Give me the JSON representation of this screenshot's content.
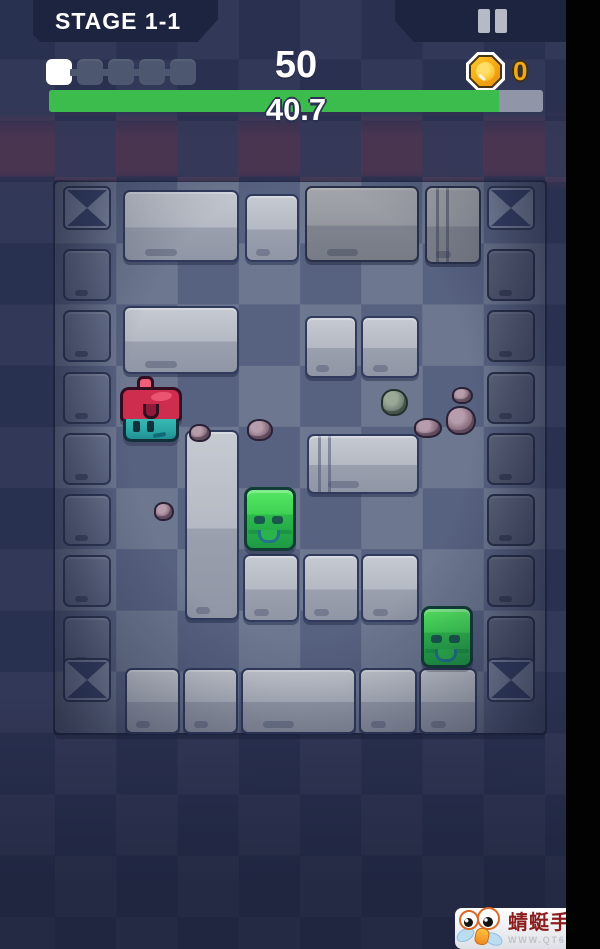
{
  "hud": {
    "stage_label": "STAGE 1-1",
    "score": "50",
    "coin_count": "0",
    "lives": {
      "total": 5,
      "filled": 1
    },
    "progress": {
      "label": "40.7",
      "percent": 91
    }
  },
  "icons": {
    "pause": "pause-icon",
    "coin": "coin-icon",
    "life_square": "life-pip-icon"
  },
  "colors": {
    "background_navy": "#2b3252",
    "panel_navy": "#1d2440",
    "progress_green": "#3bbc4d",
    "progress_track_gray": "#9096a7",
    "coin_gold": "#efa91b",
    "life_filled_white": "#ffffff",
    "life_empty_gray": "#4e5770",
    "slime_green": "#3ed254",
    "player_cap_red": "#ce2d4d",
    "player_body_teal": "#2aa5a3",
    "letterbox_black": "#020203"
  },
  "watermark": {
    "site_name": "蜻蜓手游网",
    "site_url": "WWW.QT6.COM"
  },
  "scene": {
    "field": {
      "x": 55,
      "y": 182,
      "w": 490,
      "h": 551,
      "cols": 8,
      "rows": 9
    },
    "corners": [
      [
        8,
        4
      ],
      [
        432,
        4
      ],
      [
        8,
        476
      ],
      [
        432,
        476
      ]
    ],
    "border_columns": {
      "ys": [
        67,
        128,
        190,
        251,
        312,
        373,
        434
      ],
      "left_x": 8,
      "right_x": 432
    },
    "slabs": [
      {
        "x": 68,
        "y": 8,
        "w": 116,
        "h": 72,
        "v": "light"
      },
      {
        "x": 190,
        "y": 12,
        "w": 54,
        "h": 68,
        "v": "light"
      },
      {
        "x": 250,
        "y": 4,
        "w": 114,
        "h": 76,
        "v": "dim"
      },
      {
        "x": 370,
        "y": 4,
        "w": 56,
        "h": 78,
        "v": "dim",
        "seams": true
      },
      {
        "x": 68,
        "y": 124,
        "w": 116,
        "h": 68,
        "v": "light"
      },
      {
        "x": 250,
        "y": 134,
        "w": 52,
        "h": 62,
        "v": "light"
      },
      {
        "x": 306,
        "y": 134,
        "w": 58,
        "h": 62,
        "v": "light"
      },
      {
        "x": 130,
        "y": 248,
        "w": 54,
        "h": 190,
        "v": "light"
      },
      {
        "x": 252,
        "y": 252,
        "w": 112,
        "h": 60,
        "v": "light",
        "seams": true
      },
      {
        "x": 188,
        "y": 372,
        "w": 56,
        "h": 68,
        "v": "light"
      },
      {
        "x": 248,
        "y": 372,
        "w": 56,
        "h": 68,
        "v": "light"
      },
      {
        "x": 306,
        "y": 372,
        "w": 58,
        "h": 68,
        "v": "light"
      },
      {
        "x": 70,
        "y": 486,
        "w": 55,
        "h": 66,
        "v": "light"
      },
      {
        "x": 128,
        "y": 486,
        "w": 55,
        "h": 66,
        "v": "light"
      },
      {
        "x": 186,
        "y": 486,
        "w": 115,
        "h": 66,
        "v": "light"
      },
      {
        "x": 304,
        "y": 486,
        "w": 58,
        "h": 66,
        "v": "light"
      },
      {
        "x": 364,
        "y": 486,
        "w": 58,
        "h": 66,
        "v": "light"
      }
    ],
    "rocks": [
      {
        "x": 134,
        "y": 242,
        "w": 22,
        "h": 18,
        "v": "purple"
      },
      {
        "x": 192,
        "y": 237,
        "w": 26,
        "h": 22,
        "v": "purple"
      },
      {
        "x": 326,
        "y": 207,
        "w": 27,
        "h": 27,
        "v": "green"
      },
      {
        "x": 397,
        "y": 205,
        "w": 21,
        "h": 17,
        "v": "purple"
      },
      {
        "x": 391,
        "y": 224,
        "w": 30,
        "h": 29,
        "v": "purple"
      },
      {
        "x": 359,
        "y": 236,
        "w": 28,
        "h": 20,
        "v": "purple"
      },
      {
        "x": 99,
        "y": 320,
        "w": 20,
        "h": 19,
        "v": "purple"
      }
    ],
    "entities": [
      {
        "type": "player",
        "x": 65,
        "y": 194,
        "w": 62,
        "h": 66
      },
      {
        "type": "slime",
        "x": 189,
        "y": 305,
        "w": 52,
        "h": 64
      },
      {
        "type": "slime",
        "x": 366,
        "y": 424,
        "w": 52,
        "h": 62
      }
    ]
  }
}
